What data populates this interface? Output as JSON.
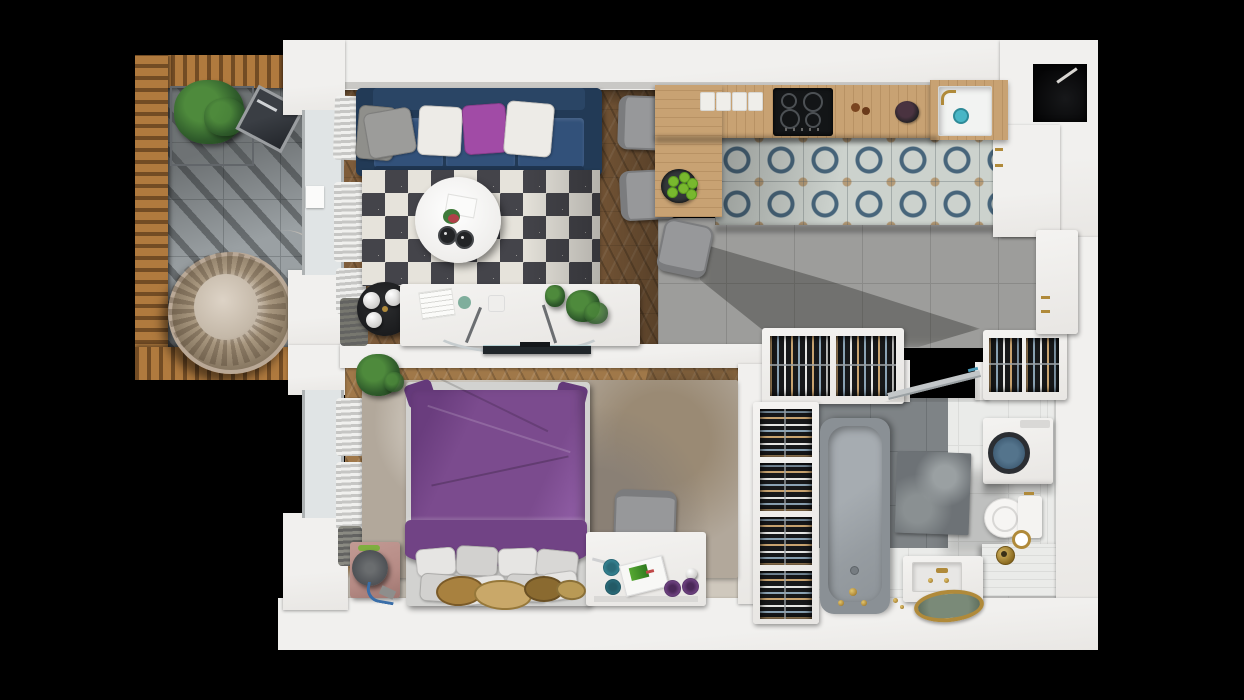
{
  "scene": {
    "title": "3d-apartment-floor-plan-top-view",
    "description": "Photorealistic top-down 3D render of a one-bedroom apartment with balcony, on a black background",
    "width_px": 1244,
    "height_px": 700
  },
  "colors": {
    "background": "#000000",
    "wall": "#f1f0ee",
    "wall_edge": "#c9c8c5",
    "window_glass": "#e0e4e5",
    "window_frame": "#aeb2b3",
    "curtain_light": "#f0f0ee",
    "curtain_mid": "#c6c6c4",
    "curtain_dark": "#636361",
    "wood_living": "#7e5c3a",
    "wood_bedroom": "#a07849",
    "counter_oak": "#c8a273",
    "balcony_tile": "#9aa0a3",
    "balcony_grout": "#7f8588",
    "pergola_wood": "#b07a3e",
    "concrete_tile": "#9d9d9b",
    "concrete_grout": "#8a8a88",
    "pattern_base": "#ccd2cd",
    "pattern_blue": "#47657b",
    "pattern_tan": "#b59b77",
    "bath_tile": "#eaebe9",
    "bath_grout": "#dbdcda",
    "bath_dark_tile": "#7e8386",
    "bath_dark_grout": "#6d7275",
    "tub_body": "#8a9095",
    "tub_inner": "#9ba1a6",
    "sofa_navy": "#32517a",
    "sofa_navy_dark": "#223a56",
    "pillow_gray": "#9c9c9a",
    "pillow_white": "#edebe7",
    "pillow_purple": "#a14ba6",
    "rug_light": "#e6e3db",
    "rug_dark": "#44444a",
    "bed_purple": "#7b4b8e",
    "bed_purple_dark": "#64397a",
    "bed_rug": "#b2a89b",
    "nightstand_rose": "#b68b85",
    "white_furniture": "#f4f3f1",
    "chair_gray": "#97989a",
    "chair_gray_dark": "#7b7c7e",
    "closet_dark": "#17181a",
    "cloth_tan": "#c9a36f",
    "cloth_blue": "#8ba3b5",
    "cloth_white": "#e5e5e3",
    "gold": "#b08a3a",
    "teal": "#49b6c6",
    "plant_green": "#2f5b2b",
    "plant_green_light": "#4e8a3c",
    "plant_green_dark": "#1d3d1a",
    "apple_green": "#78b82e",
    "lamp_gray": "#55585a",
    "mat_dark": "#6d7276",
    "jute": "#a8813f",
    "tv_dark": "#20262a",
    "glass_line": "#c3c7c9"
  },
  "rooms": [
    {
      "name": "balcony",
      "floor": "gray-tile",
      "items": [
        "wood-pergola-frame",
        "wire-planter-with-shrub",
        "leaning-mirror",
        "hanging-rattan-egg-chair"
      ]
    },
    {
      "name": "living-room",
      "floor": "walnut-chevron-wood",
      "items": [
        "navy-three-seat-sofa",
        "throw-pillows",
        "diamond-pattern-rug",
        "round-white-coffee-table",
        "two-candles",
        "flower-vase",
        "black-side-table",
        "three-white-sphere-ornaments",
        "white-media-console",
        "curved-glass-desk-legs",
        "wall-tv",
        "window-curtains",
        "potted-plants"
      ]
    },
    {
      "name": "kitchen-dining",
      "floor": "patterned-cement-tile-and-concrete",
      "items": [
        "l-shaped-oak-counter",
        "four-burner-cooktop",
        "four-white-boards",
        "sink-with-gold-faucet",
        "black-fruit-bowl",
        "plate-of-green-apples",
        "three-gray-dining-chairs",
        "tall-white-cabinets-gold-handles",
        "black-ventilation-shaft"
      ]
    },
    {
      "name": "bedroom",
      "floor": "oak-chevron-wood",
      "items": [
        "double-bed-purple-duvet",
        "eight-white-pillows",
        "marbled-area-rug",
        "rose-nightstand",
        "dark-dome-table-lamp",
        "white-desk",
        "gray-desk-chair",
        "desk-accessories",
        "jute-round-mats",
        "window-curtains",
        "potted-plant",
        "wall-mounted-tv"
      ]
    },
    {
      "name": "wardrobe",
      "floor": "none",
      "items": [
        "top-hanging-clothes-closet",
        "right-hanging-clothes-closet",
        "tall-four-bay-closet",
        "white-cabinet-with-gold-handles"
      ]
    },
    {
      "name": "bathroom",
      "floor": "white-and-dark-gray-tile",
      "items": [
        "bathtub-with-gold-faucet",
        "washing-machine",
        "toilet",
        "gold-toilet-paper-holder",
        "marble-sink-block-gold-faucet",
        "gold-round-tray",
        "dark-bath-mat",
        "tiled-bench",
        "gold-waste-bin",
        "glass-swing-door"
      ]
    }
  ],
  "counts": {
    "sofa_pillows": 4,
    "bed_pillows": 8,
    "dining_chairs": 3,
    "apples": 6,
    "white_boards": 4,
    "tall_closet_bays": 4,
    "cooktop_burners": 4
  }
}
